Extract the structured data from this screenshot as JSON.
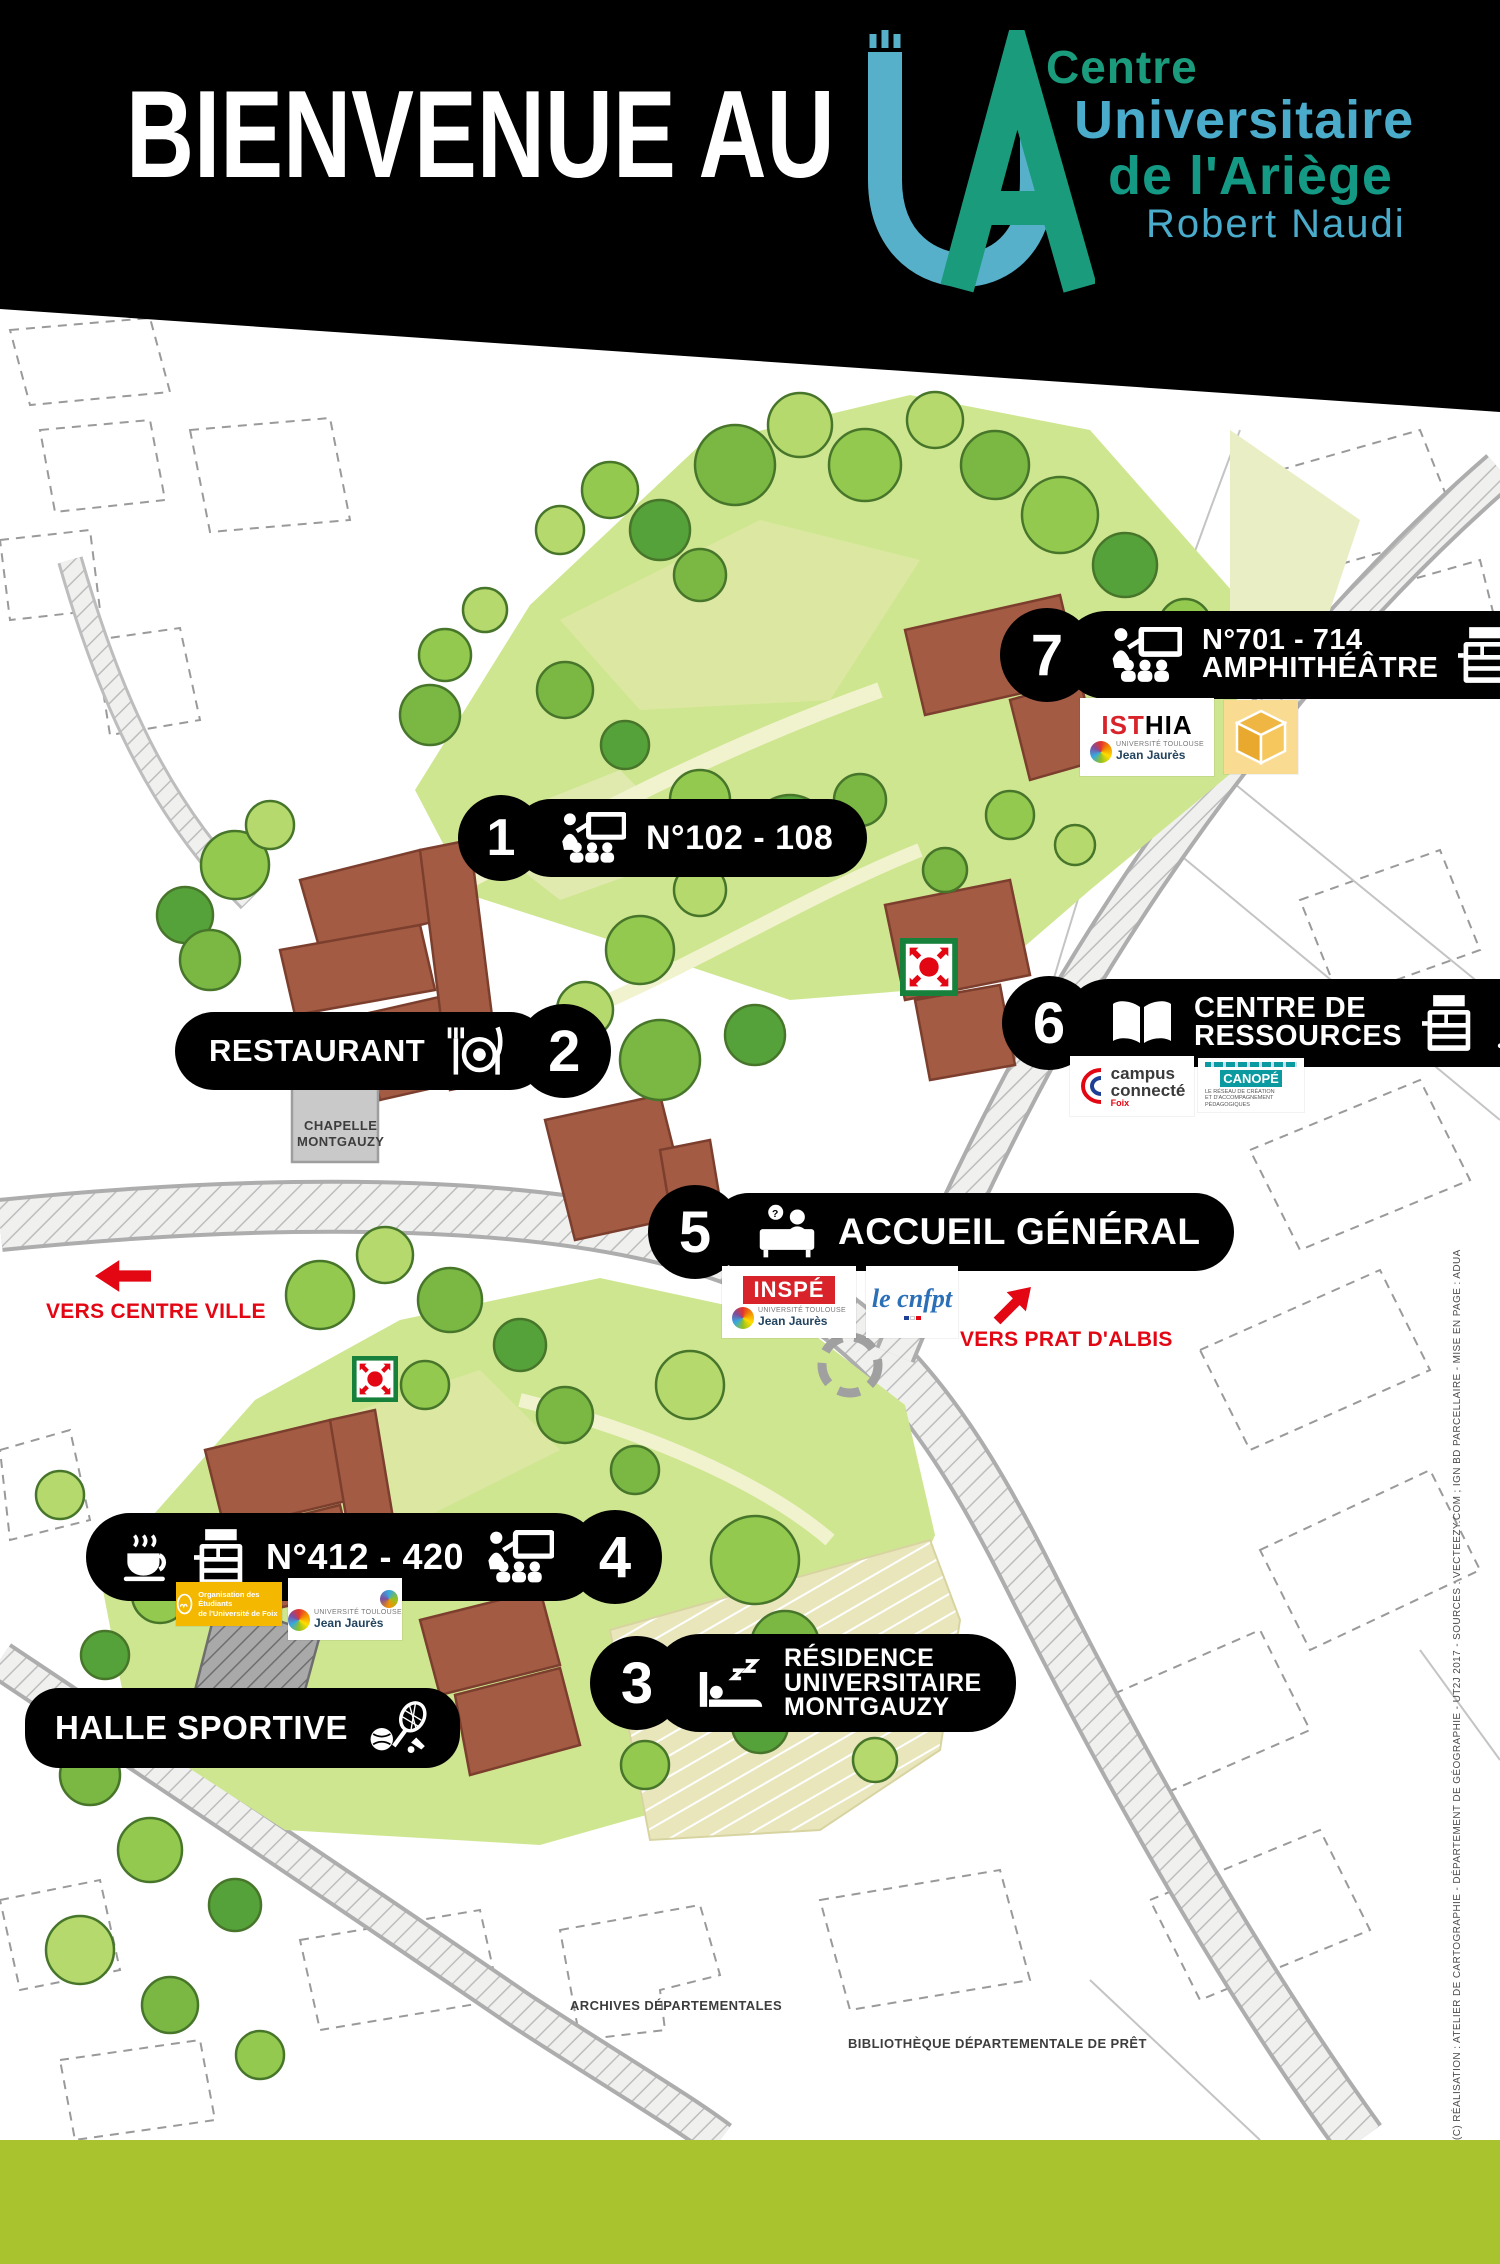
{
  "header": {
    "welcome": "BIENVENUE AU",
    "brand": {
      "line1": "Centre",
      "line2": "Universitaire",
      "line3": "de l'Ariège",
      "line4": "Robert Naudi"
    }
  },
  "colors": {
    "brand_green": "#1a9b7c",
    "brand_blue": "#4aabcb",
    "accent_red": "#e30613",
    "footer_green": "#a8c32d",
    "building_brown": "#a35b44"
  },
  "badges": {
    "b1": {
      "number": "1",
      "label": "N°102 - 108"
    },
    "b2": {
      "number": "2",
      "label": "RESTAURANT"
    },
    "b3": {
      "number": "3",
      "line1": "RÉSIDENCE",
      "line2": "UNIVERSITAIRE",
      "line3": "MONTGAUZY"
    },
    "b4": {
      "number": "4",
      "label": "N°412 - 420"
    },
    "b5": {
      "number": "5",
      "label": "ACCUEIL GÉNÉRAL"
    },
    "b6": {
      "number": "6",
      "line1": "CENTRE DE",
      "line2": "RESSOURCES"
    },
    "b7": {
      "number": "7",
      "line1": "N°701 - 714",
      "line2": "AMPHITHÉÂTRE"
    },
    "halle": {
      "label": "HALLE SPORTIVE"
    }
  },
  "directions": {
    "centre_ville": "VERS CENTRE VILLE",
    "prat_albis": "VERS PRAT D'ALBIS",
    "parking": "PARKING"
  },
  "map_labels": {
    "chapelle_line1": "CHAPELLE",
    "chapelle_line2": "MONTGAUZY",
    "archives": "ARCHIVES DÉPARTEMENTALES",
    "bibliotheque": "BIBLIOTHÈQUE DÉPARTEMENTALE DE PRÊT"
  },
  "logos": {
    "isthia": {
      "name1": "IST",
      "name2": "HIA",
      "sub1": "UNIVERSITÉ TOULOUSE",
      "sub2": "Jean Jaurès"
    },
    "campus_connecte": {
      "line1": "campus",
      "line2": "connecté",
      "sub": "Foix"
    },
    "canope": {
      "name": "CANOPÉ",
      "sub1": "LE RÉSEAU DE CRÉATION",
      "sub2": "ET D'ACCOMPAGNEMENT PÉDAGOGIQUES"
    },
    "inspe": {
      "name": "INSPÉ",
      "sub1": "UNIVERSITÉ TOULOUSE",
      "sub2": "Jean Jaurès"
    },
    "cnfpt": {
      "name": "le cnfpt"
    },
    "foix": {
      "line1": "Organisation des Étudiants",
      "line2": "de l'Université de Foix"
    },
    "utjj": {
      "sub1": "UNIVERSITÉ TOULOUSE",
      "sub2": "Jean Jaurès"
    }
  },
  "credit": "(C) RÉALISATION : ATELIER DE CARTOGRAPHIE - DÉPARTEMENT DE GÉOGRAPHIE - UT2J 2017 - SOURCES : VECTEEZY.COM ; IGN BD PARCELLAIRE - MISE EN PAGE : ADUA"
}
